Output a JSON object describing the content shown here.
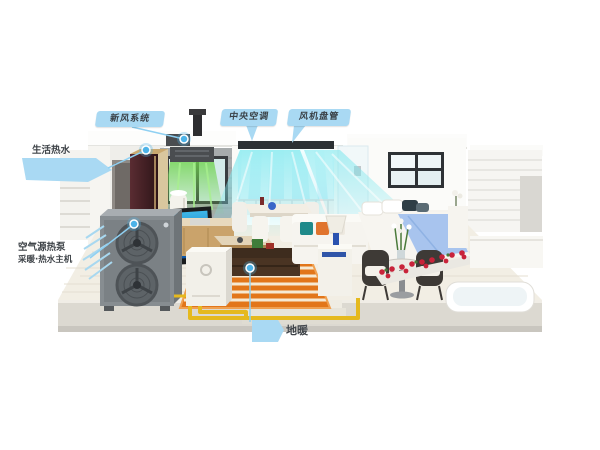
{
  "callouts": {
    "fresh_air": {
      "label": "新风系统"
    },
    "central_ac": {
      "label": "中央空调"
    },
    "fan_coil": {
      "label": "风机盘管"
    },
    "hot_water": {
      "label": "生活热水"
    },
    "heat_pump": {
      "line1": "空气源热泵",
      "line2": "采暖·热水主机"
    },
    "floor_heating": {
      "label": "地暖"
    }
  },
  "colors": {
    "callout_bubble": "#a9d9f3",
    "callout_text": "#3a4147",
    "leader_line": "#8fd0f2",
    "marker_dot": "#4db3e8",
    "flow_cool": "#7fe8ee",
    "flow_fresh": "#6fd24f",
    "pipe_yellow": "#e5b91e",
    "floor_heating_rug": "#e2761a",
    "heat_pump_body": "#878d91",
    "indoor_unit_front": "#44242a",
    "bed_blanket": "#a8c4ee",
    "flower_red": "#c8233a"
  }
}
